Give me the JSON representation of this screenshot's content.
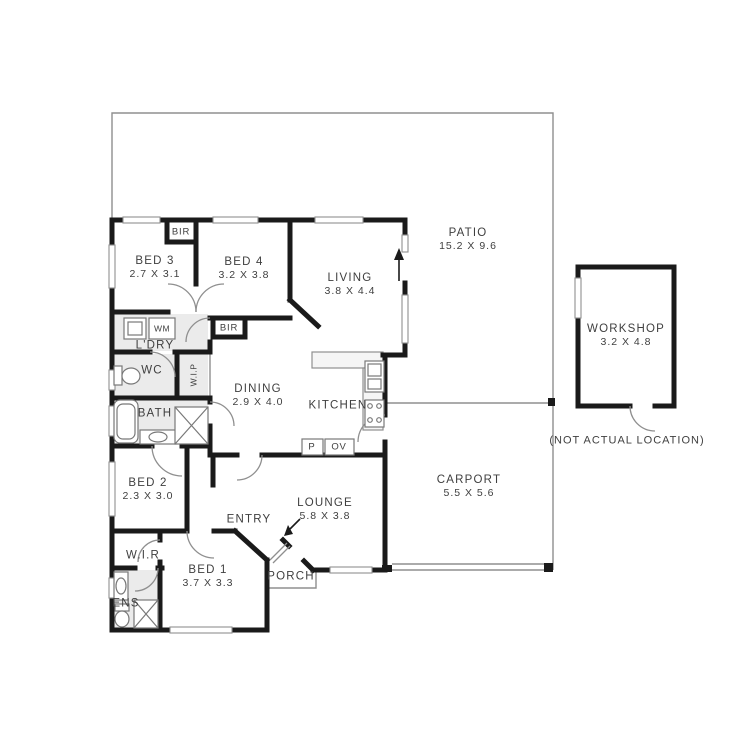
{
  "plan_title": "house floor plan",
  "colors": {
    "background": "#ffffff",
    "walls": "#1a1a1a",
    "thin_lines": "#8f8f8f",
    "text": "#3f3f3f",
    "wet_area_fill": "#ebebeb",
    "counter_fill": "#f5f5f5"
  },
  "rooms": {
    "bed1": {
      "name": "BED 1",
      "dims": "3.7 X 3.3"
    },
    "bed2": {
      "name": "BED 2",
      "dims": "2.3 X 3.0"
    },
    "bed3": {
      "name": "BED 3",
      "dims": "2.7 X 3.1"
    },
    "bed4": {
      "name": "BED 4",
      "dims": "3.2 X 3.8"
    },
    "living": {
      "name": "LIVING",
      "dims": "3.8 X 4.4"
    },
    "dining": {
      "name": "DINING",
      "dims": "2.9 X 4.0"
    },
    "lounge": {
      "name": "LOUNGE",
      "dims": "5.8 X 3.8"
    },
    "kitchen": {
      "name": "KITCHEN"
    },
    "patio": {
      "name": "PATIO",
      "dims": "15.2 X 9.6"
    },
    "carport": {
      "name": "CARPORT",
      "dims": "5.5 X 5.6"
    },
    "workshop": {
      "name": "WORKSHOP",
      "dims": "3.2 X 4.8",
      "note": "(NOT ACTUAL LOCATION)"
    },
    "porch": {
      "name": "PORCH"
    },
    "entry": {
      "name": "ENTRY"
    },
    "laundry": {
      "name": "L'DRY"
    },
    "wc": {
      "name": "WC"
    },
    "wip": {
      "name": "W.I.P"
    },
    "bath": {
      "name": "BATH"
    },
    "ens": {
      "name": "ENS"
    },
    "wir": {
      "name": "W.I.R"
    }
  },
  "fixtures": {
    "bir": "BIR",
    "wm": "WM",
    "pantry": "P",
    "oven": "OV"
  }
}
